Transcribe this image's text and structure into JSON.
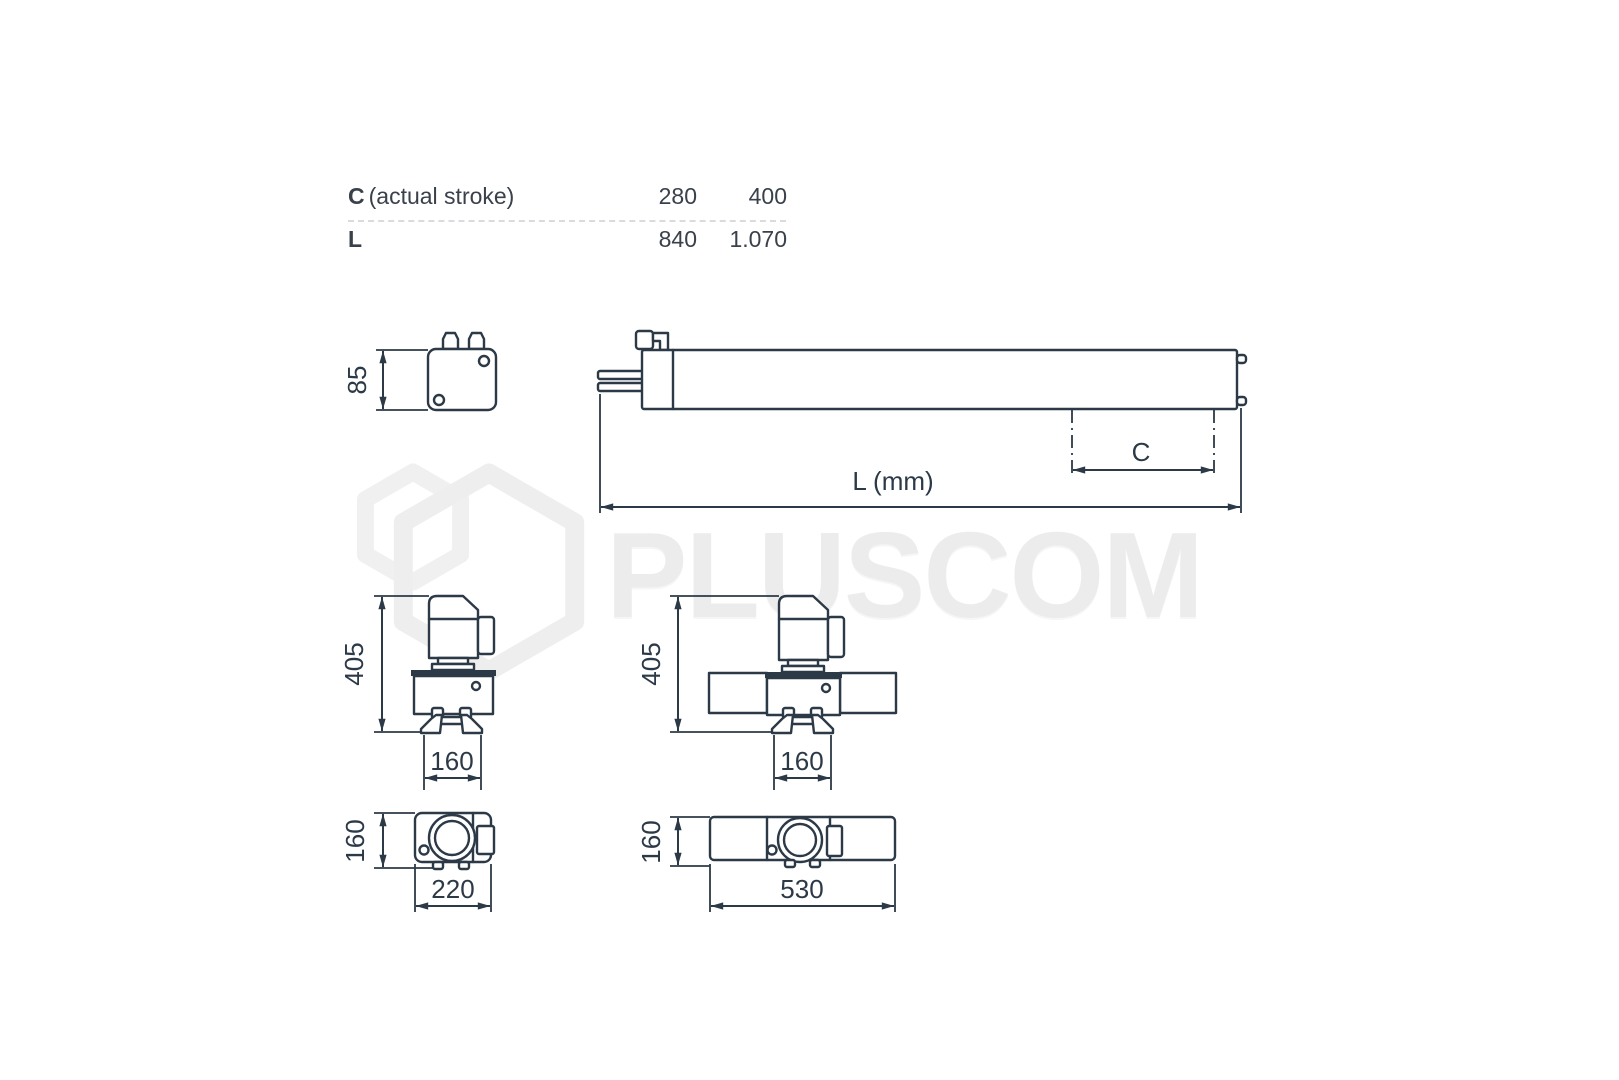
{
  "spec_table": {
    "rows": [
      {
        "key": "C",
        "description": "(actual stroke)",
        "values": [
          "280",
          "400"
        ]
      },
      {
        "key": "L",
        "description": "",
        "values": [
          "840",
          "1.070"
        ]
      }
    ]
  },
  "watermark": {
    "brand": "PLUSCOM"
  },
  "drawing": {
    "end_view_small": {
      "height": "85"
    },
    "side_view": {
      "stroke_label": "C",
      "length_label": "L (mm)"
    },
    "front_view_left": {
      "height": "405",
      "width": "160"
    },
    "front_view_right": {
      "height": "405",
      "width": "160"
    },
    "top_view_small": {
      "depth": "160",
      "width": "220"
    },
    "top_view_long": {
      "depth": "160",
      "width": "530"
    }
  },
  "colors": {
    "line": "#2c3947",
    "table_text": "#3a414b",
    "watermark": "#ececec",
    "separator": "#d9dbde"
  }
}
